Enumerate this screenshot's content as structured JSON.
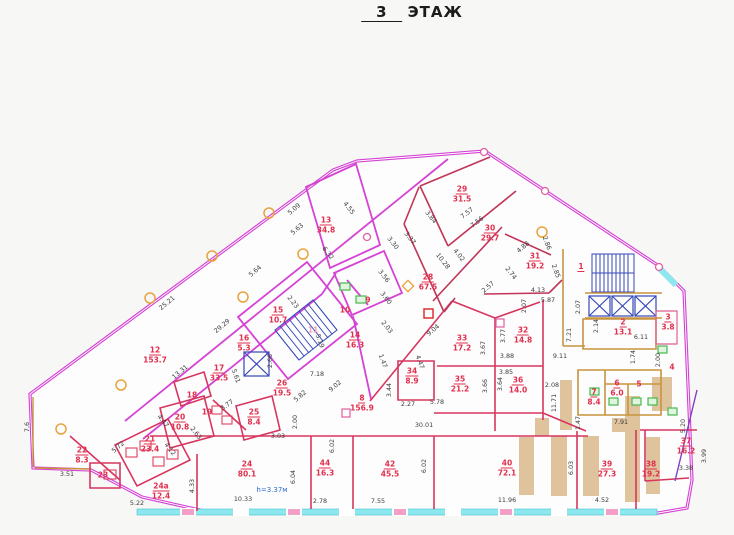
{
  "title": {
    "floor_number": "3",
    "floor_word": "ЭТАЖ"
  },
  "plan": {
    "height_note": "h=3.37м",
    "colors": {
      "outer_wall": "#d543d5",
      "partition": "#d6365f",
      "dark_partition": "#c03558",
      "core_wall": "#c8943f",
      "stairs_elevator": "#3548b8",
      "window": "#8ce8ee",
      "column": "#e8a33d",
      "shaft_fill": "#d9b98c",
      "room_label": "#e0304e",
      "dim_text": "#3c3c3c",
      "fixture_green": "#49b84f",
      "fixture_red": "#e04060"
    },
    "rooms": [
      {
        "num": "1",
        "area": "",
        "x": 581,
        "y": 267
      },
      {
        "num": "2",
        "area": "13.1",
        "x": 623,
        "y": 327
      },
      {
        "num": "3",
        "area": "3.8",
        "x": 668,
        "y": 322
      },
      {
        "num": "4",
        "area": "",
        "x": 672,
        "y": 367
      },
      {
        "num": "5",
        "area": "",
        "x": 639,
        "y": 384
      },
      {
        "num": "6",
        "area": "6.0",
        "x": 617,
        "y": 388
      },
      {
        "num": "7",
        "area": "8.4",
        "x": 594,
        "y": 397
      },
      {
        "num": "8",
        "area": "156.9",
        "x": 362,
        "y": 403
      },
      {
        "num": "9",
        "area": "",
        "x": 368,
        "y": 300
      },
      {
        "num": "10",
        "area": "",
        "x": 345,
        "y": 310
      },
      {
        "num": "11",
        "area": "",
        "x": 313,
        "y": 330,
        "c": "#f0a0b8"
      },
      {
        "num": "12",
        "area": "153.7",
        "x": 155,
        "y": 355
      },
      {
        "num": "13",
        "area": "34.8",
        "x": 326,
        "y": 225
      },
      {
        "num": "14",
        "area": "16.3",
        "x": 355,
        "y": 340
      },
      {
        "num": "15",
        "area": "10.7",
        "x": 278,
        "y": 315
      },
      {
        "num": "16",
        "area": "5.3",
        "x": 244,
        "y": 343
      },
      {
        "num": "17",
        "area": "33.5",
        "x": 219,
        "y": 373
      },
      {
        "num": "18",
        "area": "",
        "x": 192,
        "y": 395
      },
      {
        "num": "19",
        "area": "",
        "x": 207,
        "y": 412
      },
      {
        "num": "20",
        "area": "10.8",
        "x": 180,
        "y": 422
      },
      {
        "num": "21",
        "area": "23.4",
        "x": 150,
        "y": 444
      },
      {
        "num": "22",
        "area": "8.3",
        "x": 82,
        "y": 455
      },
      {
        "num": "23",
        "area": "",
        "x": 103,
        "y": 475
      },
      {
        "num": "24",
        "area": "80.1",
        "x": 247,
        "y": 469
      },
      {
        "num": "24а",
        "area": "12.4",
        "x": 161,
        "y": 491
      },
      {
        "num": "25",
        "area": "8.4",
        "x": 254,
        "y": 417
      },
      {
        "num": "26",
        "area": "19.5",
        "x": 282,
        "y": 388
      },
      {
        "num": "28",
        "area": "67.5",
        "x": 428,
        "y": 282
      },
      {
        "num": "29",
        "area": "31.5",
        "x": 462,
        "y": 194
      },
      {
        "num": "30",
        "area": "29.7",
        "x": 490,
        "y": 233
      },
      {
        "num": "31",
        "area": "19.2",
        "x": 535,
        "y": 261
      },
      {
        "num": "32",
        "area": "14.8",
        "x": 523,
        "y": 335
      },
      {
        "num": "33",
        "area": "17.2",
        "x": 462,
        "y": 343
      },
      {
        "num": "34",
        "area": "8.9",
        "x": 412,
        "y": 376
      },
      {
        "num": "35",
        "area": "21.2",
        "x": 460,
        "y": 384
      },
      {
        "num": "36",
        "area": "14.0",
        "x": 518,
        "y": 385
      },
      {
        "num": "37",
        "area": "16.2",
        "x": 686,
        "y": 446
      },
      {
        "num": "38",
        "area": "19.2",
        "x": 651,
        "y": 469
      },
      {
        "num": "39",
        "area": "27.3",
        "x": 607,
        "y": 469
      },
      {
        "num": "40",
        "area": "72.1",
        "x": 507,
        "y": 468
      },
      {
        "num": "42",
        "area": "45.5",
        "x": 390,
        "y": 469
      },
      {
        "num": "44",
        "area": "16.3",
        "x": 325,
        "y": 468
      }
    ],
    "dimensions": [
      {
        "t": "25.21",
        "x": 167,
        "y": 303,
        "r": -40
      },
      {
        "t": "29.29",
        "x": 222,
        "y": 326,
        "r": -40
      },
      {
        "t": "13.31",
        "x": 180,
        "y": 372,
        "r": -40
      },
      {
        "t": "5.64",
        "x": 255,
        "y": 271,
        "r": -40
      },
      {
        "t": "5.09",
        "x": 294,
        "y": 209,
        "r": -40
      },
      {
        "t": "5.63",
        "x": 297,
        "y": 229,
        "r": -40
      },
      {
        "t": "4.55",
        "x": 349,
        "y": 208,
        "r": 52
      },
      {
        "t": "6.32",
        "x": 328,
        "y": 253,
        "r": 52
      },
      {
        "t": "3.30",
        "x": 393,
        "y": 243,
        "r": 52
      },
      {
        "t": "3.37",
        "x": 410,
        "y": 238,
        "r": 52
      },
      {
        "t": "3.84",
        "x": 431,
        "y": 217,
        "r": 52
      },
      {
        "t": "7.57",
        "x": 467,
        "y": 213,
        "r": -38
      },
      {
        "t": "7.56",
        "x": 477,
        "y": 222,
        "r": -38
      },
      {
        "t": "10.28",
        "x": 443,
        "y": 261,
        "r": 52
      },
      {
        "t": "4.02",
        "x": 459,
        "y": 255,
        "r": 52
      },
      {
        "t": "4.88",
        "x": 523,
        "y": 247,
        "r": -40
      },
      {
        "t": "2.86",
        "x": 547,
        "y": 243,
        "r": 70
      },
      {
        "t": "2.74",
        "x": 511,
        "y": 273,
        "r": 52
      },
      {
        "t": "2.57",
        "x": 488,
        "y": 287,
        "r": -40
      },
      {
        "t": "2.85",
        "x": 556,
        "y": 271,
        "r": 70
      },
      {
        "t": "4.13",
        "x": 538,
        "y": 290,
        "r": 0
      },
      {
        "t": "5.87",
        "x": 548,
        "y": 300,
        "r": 0
      },
      {
        "t": "2.07",
        "x": 524,
        "y": 306,
        "r": -90
      },
      {
        "t": "2.07",
        "x": 578,
        "y": 307,
        "r": -90
      },
      {
        "t": "2.14",
        "x": 596,
        "y": 326,
        "r": -90
      },
      {
        "t": "7.21",
        "x": 569,
        "y": 335,
        "r": -90
      },
      {
        "t": "9.11",
        "x": 560,
        "y": 356,
        "r": 0
      },
      {
        "t": "6.11",
        "x": 641,
        "y": 337,
        "r": 0
      },
      {
        "t": "1.74",
        "x": 633,
        "y": 357,
        "r": -90
      },
      {
        "t": "2.00",
        "x": 658,
        "y": 360,
        "r": -90
      },
      {
        "t": "5.20",
        "x": 683,
        "y": 426,
        "r": -90
      },
      {
        "t": "3.99",
        "x": 704,
        "y": 456,
        "r": -90
      },
      {
        "t": "3.38",
        "x": 686,
        "y": 468,
        "r": 0
      },
      {
        "t": "7.91",
        "x": 621,
        "y": 422,
        "r": 0
      },
      {
        "t": "1.47",
        "x": 578,
        "y": 423,
        "r": -90
      },
      {
        "t": "1.47",
        "x": 383,
        "y": 361,
        "r": 70
      },
      {
        "t": "11.71",
        "x": 554,
        "y": 403,
        "r": -90
      },
      {
        "t": "2.08",
        "x": 552,
        "y": 385,
        "r": 0
      },
      {
        "t": "6.02",
        "x": 424,
        "y": 466,
        "r": -90
      },
      {
        "t": "6.02",
        "x": 332,
        "y": 446,
        "r": -90
      },
      {
        "t": "6.03",
        "x": 571,
        "y": 468,
        "r": -90
      },
      {
        "t": "6.04",
        "x": 293,
        "y": 477,
        "r": -90
      },
      {
        "t": "10.33",
        "x": 243,
        "y": 499,
        "r": 0
      },
      {
        "t": "2.78",
        "x": 320,
        "y": 501,
        "r": 0
      },
      {
        "t": "7.55",
        "x": 378,
        "y": 501,
        "r": 0
      },
      {
        "t": "11.96",
        "x": 507,
        "y": 500,
        "r": 0
      },
      {
        "t": "4.52",
        "x": 602,
        "y": 500,
        "r": 0
      },
      {
        "t": "4.33",
        "x": 192,
        "y": 486,
        "r": -90
      },
      {
        "t": "5.22",
        "x": 137,
        "y": 503,
        "r": 0
      },
      {
        "t": "3.51",
        "x": 67,
        "y": 474,
        "r": 0
      },
      {
        "t": "7.6",
        "x": 27,
        "y": 427,
        "r": -90
      },
      {
        "t": "5.72",
        "x": 118,
        "y": 447,
        "r": -40
      },
      {
        "t": "4.47",
        "x": 163,
        "y": 421,
        "r": 52
      },
      {
        "t": "4.12",
        "x": 170,
        "y": 449,
        "r": 52
      },
      {
        "t": "2.63",
        "x": 196,
        "y": 433,
        "r": 52
      },
      {
        "t": "3.77",
        "x": 227,
        "y": 405,
        "r": -35
      },
      {
        "t": "9.02",
        "x": 335,
        "y": 386,
        "r": -40
      },
      {
        "t": "7.18",
        "x": 317,
        "y": 374,
        "r": 0
      },
      {
        "t": "5.82",
        "x": 300,
        "y": 396,
        "r": -40
      },
      {
        "t": "5.19",
        "x": 320,
        "y": 341,
        "r": 70
      },
      {
        "t": "3.44",
        "x": 389,
        "y": 390,
        "r": -90
      },
      {
        "t": "2.27",
        "x": 408,
        "y": 404,
        "r": 0
      },
      {
        "t": "5.78",
        "x": 437,
        "y": 402,
        "r": 0
      },
      {
        "t": "3.67",
        "x": 483,
        "y": 348,
        "r": -90
      },
      {
        "t": "3.66",
        "x": 485,
        "y": 386,
        "r": -90
      },
      {
        "t": "3.77",
        "x": 503,
        "y": 336,
        "r": -90
      },
      {
        "t": "3.88",
        "x": 507,
        "y": 356,
        "r": 0
      },
      {
        "t": "3.85",
        "x": 506,
        "y": 372,
        "r": 0
      },
      {
        "t": "3.64",
        "x": 500,
        "y": 384,
        "r": -90
      },
      {
        "t": "30.01",
        "x": 424,
        "y": 425,
        "r": 0
      },
      {
        "t": "3.03",
        "x": 278,
        "y": 436,
        "r": 0
      },
      {
        "t": "2.00",
        "x": 295,
        "y": 422,
        "r": -90
      },
      {
        "t": "2.03",
        "x": 387,
        "y": 327,
        "r": 52
      },
      {
        "t": "3.56",
        "x": 384,
        "y": 276,
        "r": 52
      },
      {
        "t": "3.60",
        "x": 386,
        "y": 298,
        "r": 52
      },
      {
        "t": "9.04",
        "x": 433,
        "y": 330,
        "r": -40
      },
      {
        "t": "4.47",
        "x": 420,
        "y": 362,
        "r": 70
      },
      {
        "t": "2.23",
        "x": 293,
        "y": 302,
        "r": 52
      },
      {
        "t": "5.61",
        "x": 236,
        "y": 376,
        "r": 70
      },
      {
        "t": "2.66",
        "x": 270,
        "y": 361,
        "r": -90
      }
    ]
  }
}
